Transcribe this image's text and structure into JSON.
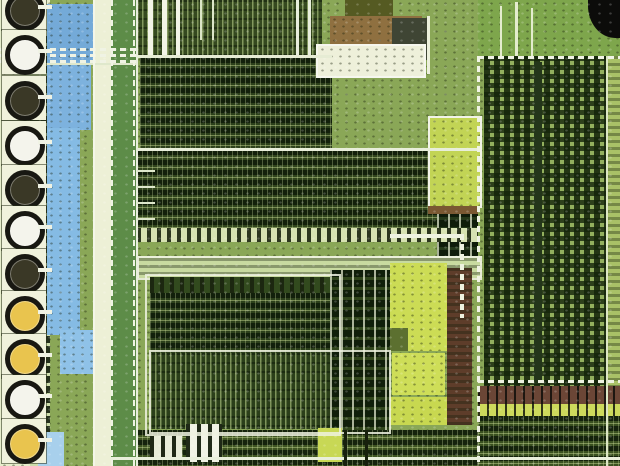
{
  "scene": {
    "type": "photomicrograph",
    "subject": "integrated-circuit die close-up",
    "description": "Optical microscope photograph of a silicon chip die: a column of round bond pads on the left, a light-blue metal bus strip, dense green standard-cell logic blocks in the center, bright yellow-green oxide regions, brown interconnect bands, and a large memory cell array on the right with a black blob in the top-right corner.",
    "visible_text": "none"
  },
  "photo": {
    "width": 620,
    "height": 466,
    "base_color": "#8aa757"
  },
  "palette": {
    "pale_field": "#e6edcb",
    "blue_metal": "#85bbe4",
    "cream": "#edf0d6",
    "bus_green": "#5d8c48",
    "dark_logic": "#2c401b",
    "mid_logic": "#31451d",
    "bright_yellow_green": "#ccdc55",
    "brown_band": "#8f7040",
    "maroon": "#5e3d2a",
    "memory_green": "#93b05e",
    "black": "#0c0c0a",
    "trace_white": "#f0f3e4",
    "pad_ring": "#181812"
  },
  "pad_column": {
    "background": "#e6edcb",
    "center_colors": {
      "dark": "#3a3826",
      "white": "#f4f4ec",
      "yellow": "#e9c44e"
    },
    "pads": [
      {
        "y": 8,
        "center": "dark"
      },
      {
        "y": 52,
        "center": "white"
      },
      {
        "y": 98,
        "center": "dark"
      },
      {
        "y": 143,
        "center": "white"
      },
      {
        "y": 187,
        "center": "dark"
      },
      {
        "y": 228,
        "center": "white"
      },
      {
        "y": 271,
        "center": "dark"
      },
      {
        "y": 313,
        "center": "yellow"
      },
      {
        "y": 356,
        "center": "yellow"
      },
      {
        "y": 397,
        "center": "white"
      },
      {
        "y": 441,
        "center": "yellow"
      }
    ]
  },
  "regions": [
    {
      "name": "base-field",
      "x": 0,
      "y": 0,
      "w": 620,
      "h": 466,
      "fill": "#8aa757",
      "tex": "speckle"
    },
    {
      "name": "pad-column",
      "x": 0,
      "y": 0,
      "w": 50,
      "h": 466,
      "fill": "#e6edcb",
      "tex": "speckle"
    },
    {
      "name": "pad-cell-strip",
      "x": 28,
      "y": 36,
      "w": 22,
      "h": 430,
      "fill": "#cdddab",
      "tex": "cells"
    },
    {
      "name": "blue-pool-top",
      "x": 47,
      "y": 4,
      "w": 48,
      "h": 58,
      "fill": "#74aad8",
      "tex": "speckle"
    },
    {
      "name": "blue-pool-mid",
      "x": 47,
      "y": 62,
      "w": 44,
      "h": 68,
      "fill": "#7db2de",
      "tex": "speckle"
    },
    {
      "name": "blue-bus-strip",
      "x": 47,
      "y": 128,
      "w": 33,
      "h": 207,
      "fill": "#85bbe4",
      "tex": "speckle"
    },
    {
      "name": "blue-pool-low",
      "x": 60,
      "y": 330,
      "w": 40,
      "h": 44,
      "fill": "#8fc2e8",
      "tex": "speckle"
    },
    {
      "name": "blue-pool-bottom",
      "x": 38,
      "y": 432,
      "w": 26,
      "h": 34,
      "fill": "#a8d0ec",
      "tex": null
    },
    {
      "name": "cream-strip",
      "x": 94,
      "y": 0,
      "w": 18,
      "h": 466,
      "fill": "#edf0d6",
      "tex": null
    },
    {
      "name": "green-power-bus",
      "x": 111,
      "y": 0,
      "w": 26,
      "h": 466,
      "fill": "#5d8c48",
      "tex": null
    },
    {
      "name": "top-logic-banner",
      "x": 137,
      "y": 0,
      "w": 185,
      "h": 58,
      "fill": "#35491f",
      "tex": "vstripes"
    },
    {
      "name": "top-dense-block",
      "x": 140,
      "y": 58,
      "w": 192,
      "h": 92,
      "fill": "#2c401b",
      "tex": "logic-rows"
    },
    {
      "name": "olive-patch",
      "x": 345,
      "y": 0,
      "w": 48,
      "h": 18,
      "fill": "#555a22",
      "tex": null
    },
    {
      "name": "brown-band-top",
      "x": 330,
      "y": 16,
      "w": 92,
      "h": 28,
      "fill": "#8f7040",
      "tex": "speckle"
    },
    {
      "name": "gray-block",
      "x": 392,
      "y": 18,
      "w": 38,
      "h": 42,
      "fill": "#3f4534",
      "tex": null
    },
    {
      "name": "cream-block",
      "x": 316,
      "y": 44,
      "w": 106,
      "h": 30,
      "fill": "#eef0da",
      "tex": "speckle",
      "border": "2px solid #f6f7ee"
    },
    {
      "name": "mid-logic-block",
      "x": 137,
      "y": 150,
      "w": 300,
      "h": 82,
      "fill": "#31451d",
      "tex": "logic-rows"
    },
    {
      "name": "cell-column-right",
      "x": 437,
      "y": 150,
      "w": 41,
      "h": 106,
      "fill": "#24381a",
      "tex": "cells"
    },
    {
      "name": "bright-cell-row",
      "x": 137,
      "y": 228,
      "w": 341,
      "h": 14,
      "fill": "#d7e2b2",
      "tex": "comb"
    },
    {
      "name": "light-bus-strip",
      "x": 137,
      "y": 256,
      "w": 341,
      "h": 20,
      "fill": "#c8daa0",
      "tex": "hrows-soft",
      "border": "2px solid rgba(238,242,224,0.9)"
    },
    {
      "name": "comb-row-lower-left",
      "x": 150,
      "y": 277,
      "w": 180,
      "h": 16,
      "fill": "#324a1e",
      "tex": "comb"
    },
    {
      "name": "lower-left-dense",
      "x": 150,
      "y": 293,
      "w": 180,
      "h": 60,
      "fill": "#2c401b",
      "tex": "logic-rows"
    },
    {
      "name": "stripe-panel",
      "x": 150,
      "y": 353,
      "w": 235,
      "h": 76,
      "fill": "#2b3f1a",
      "tex": "vstripes"
    },
    {
      "name": "cell-pair-column",
      "x": 330,
      "y": 270,
      "w": 60,
      "h": 160,
      "fill": "#30451c",
      "tex": "cells"
    },
    {
      "name": "yellow-field-a",
      "x": 390,
      "y": 263,
      "w": 57,
      "h": 88,
      "fill": "#ccdc55",
      "tex": "speckle"
    },
    {
      "name": "yellow-notch",
      "x": 390,
      "y": 328,
      "w": 18,
      "h": 23,
      "fill": "#5c7030",
      "tex": null
    },
    {
      "name": "yellow-field-b",
      "x": 392,
      "y": 353,
      "w": 53,
      "h": 42,
      "fill": "#cede58",
      "tex": "speckle"
    },
    {
      "name": "yellow-field-c",
      "x": 390,
      "y": 397,
      "w": 57,
      "h": 28,
      "fill": "#c8d850",
      "tex": "speckle"
    },
    {
      "name": "maroon-strip",
      "x": 447,
      "y": 268,
      "w": 25,
      "h": 157,
      "fill": "#5e3d2a",
      "tex": "hrows-soft"
    },
    {
      "name": "framed-yellow-block",
      "x": 428,
      "y": 116,
      "w": 50,
      "h": 88,
      "fill": "#c2d455",
      "tex": "speckle",
      "border": "2px solid #f2f4e8"
    },
    {
      "name": "brown-sliver",
      "x": 428,
      "y": 206,
      "w": 50,
      "h": 8,
      "fill": "#7a5832",
      "tex": null
    },
    {
      "name": "memory-apron",
      "x": 478,
      "y": 0,
      "w": 142,
      "h": 56,
      "fill": "#7ea64c",
      "tex": "speckle"
    },
    {
      "name": "memory-array",
      "x": 484,
      "y": 56,
      "w": 124,
      "h": 330,
      "fill": "#93b05e",
      "tex": "grid"
    },
    {
      "name": "memory-divider",
      "x": 534,
      "y": 62,
      "w": 8,
      "h": 322,
      "fill": "#24361a",
      "tex": null
    },
    {
      "name": "memory-edge-column",
      "x": 608,
      "y": 56,
      "w": 12,
      "h": 410,
      "fill": "#a9c167",
      "tex": "hrows-soft"
    },
    {
      "name": "corner-blob",
      "x": 588,
      "y": 0,
      "w": 32,
      "h": 38,
      "fill": "#0c0c0a",
      "tex": null,
      "radius": "0 0 0 85%"
    },
    {
      "name": "brown-band-right",
      "x": 478,
      "y": 386,
      "w": 142,
      "h": 18,
      "fill": "#6b4636",
      "tex": "ticks-v"
    },
    {
      "name": "yellow-strip-right",
      "x": 478,
      "y": 404,
      "w": 142,
      "h": 12,
      "fill": "#cdd95c",
      "tex": "ticks-v"
    },
    {
      "name": "bottom-right-dense",
      "x": 478,
      "y": 416,
      "w": 142,
      "h": 50,
      "fill": "#3a5020",
      "tex": "logic-rows"
    },
    {
      "name": "bottom-mid-dense",
      "x": 137,
      "y": 430,
      "w": 341,
      "h": 36,
      "fill": "#3f5522",
      "tex": "logic-rows"
    },
    {
      "name": "yellow-patch-bottom",
      "x": 318,
      "y": 428,
      "w": 24,
      "h": 34,
      "fill": "#c8d855",
      "tex": null
    },
    {
      "name": "ladder-structure-large",
      "x": 186,
      "y": 424,
      "w": 36,
      "h": 38,
      "fill": "#f0f2e4",
      "tex": "comb-big"
    },
    {
      "name": "ladder-structure-small",
      "x": 150,
      "y": 436,
      "w": 32,
      "h": 24,
      "fill": "#e8ecd8",
      "tex": "comb-big"
    },
    {
      "name": "frame-lower-left",
      "x": 145,
      "y": 274,
      "w": 192,
      "h": 158,
      "fill": "none",
      "tex": null,
      "border": "2px solid rgba(238,242,224,0.85)"
    },
    {
      "name": "frame-stripe-panel",
      "x": 149,
      "y": 350,
      "w": 238,
      "h": 80,
      "fill": "none",
      "tex": null,
      "border": "2px solid rgba(238,242,224,0.85)"
    },
    {
      "name": "photo-grain",
      "x": 0,
      "y": 0,
      "w": 620,
      "h": 466,
      "fill": "none",
      "tex": "speckle-lt"
    }
  ],
  "lines": [
    {
      "name": "pad-bus-trace-1",
      "x": 0,
      "y": 48,
      "w": 137,
      "h": 3,
      "color": "#f0f3e4",
      "dash": "h"
    },
    {
      "name": "pad-bus-trace-2",
      "x": 0,
      "y": 54,
      "w": 137,
      "h": 3,
      "color": "#f0f3e4",
      "dash": "h"
    },
    {
      "name": "pad-bus-trace-3",
      "x": 0,
      "y": 60,
      "w": 137,
      "h": 3,
      "color": "#f0f3e4",
      "dash": "h"
    },
    {
      "name": "blue-divider",
      "x": 47,
      "y": 63,
      "w": 90,
      "h": 2,
      "color": "#dfe8cc",
      "dash": null
    },
    {
      "name": "cream-left-edge",
      "x": 93,
      "y": 0,
      "w": 2,
      "h": 466,
      "color": "#f4f6e8",
      "dash": null
    },
    {
      "name": "bus-dash-left",
      "x": 111,
      "y": 0,
      "w": 2,
      "h": 466,
      "color": "#f0f3e4",
      "dash": "v"
    },
    {
      "name": "bus-dash-right",
      "x": 133,
      "y": 0,
      "w": 2,
      "h": 466,
      "color": "#f0f3e4",
      "dash": "v"
    },
    {
      "name": "main-left-edge",
      "x": 136,
      "y": 0,
      "w": 2,
      "h": 466,
      "color": "#e8eedc",
      "dash": null
    },
    {
      "name": "bondwire-bar-1",
      "x": 148,
      "y": 0,
      "w": 5,
      "h": 58,
      "color": "#f2f4e6",
      "dash": null
    },
    {
      "name": "bondwire-bar-2",
      "x": 162,
      "y": 0,
      "w": 5,
      "h": 58,
      "color": "#f2f4e6",
      "dash": null
    },
    {
      "name": "bondwire-bar-3",
      "x": 176,
      "y": 0,
      "w": 4,
      "h": 58,
      "color": "#f2f4e6",
      "dash": null
    },
    {
      "name": "top-thin-line-1",
      "x": 200,
      "y": 0,
      "w": 2,
      "h": 40,
      "color": "#dce6c8",
      "dash": null
    },
    {
      "name": "top-thin-line-2",
      "x": 212,
      "y": 0,
      "w": 2,
      "h": 40,
      "color": "#dce6c8",
      "dash": null
    },
    {
      "name": "top-thin-line-3",
      "x": 296,
      "y": 0,
      "w": 3,
      "h": 58,
      "color": "#e8eedc",
      "dash": null
    },
    {
      "name": "top-thin-line-4",
      "x": 308,
      "y": 0,
      "w": 3,
      "h": 58,
      "color": "#e8eedc",
      "dash": null
    },
    {
      "name": "h-bus-55",
      "x": 137,
      "y": 55,
      "w": 195,
      "h": 3,
      "color": "#e6ecd4",
      "dash": null
    },
    {
      "name": "h-bus-148",
      "x": 137,
      "y": 148,
      "w": 341,
      "h": 3,
      "color": "#e8eeda",
      "dash": null
    },
    {
      "name": "bus-stub-1",
      "x": 137,
      "y": 170,
      "w": 18,
      "h": 2,
      "color": "#dfe8cc",
      "dash": null
    },
    {
      "name": "bus-stub-2",
      "x": 137,
      "y": 186,
      "w": 18,
      "h": 2,
      "color": "#dfe8cc",
      "dash": null
    },
    {
      "name": "bus-stub-3",
      "x": 137,
      "y": 202,
      "w": 18,
      "h": 2,
      "color": "#dfe8cc",
      "dash": null
    },
    {
      "name": "bus-stub-4",
      "x": 137,
      "y": 218,
      "w": 18,
      "h": 2,
      "color": "#dfe8cc",
      "dash": null
    },
    {
      "name": "trace-h-236",
      "x": 390,
      "y": 234,
      "w": 74,
      "h": 4,
      "color": "#eef2e0",
      "dash": null
    },
    {
      "name": "trace-v-460",
      "x": 460,
      "y": 234,
      "w": 4,
      "h": 84,
      "color": "#eef2e0",
      "dash": "v"
    },
    {
      "name": "vertical-trace-428",
      "x": 427,
      "y": 16,
      "w": 3,
      "h": 58,
      "color": "#ecf0dc",
      "dash": null
    },
    {
      "name": "memory-border-h",
      "x": 478,
      "y": 56,
      "w": 142,
      "h": 3,
      "color": "#f0f3e4",
      "dash": "h"
    },
    {
      "name": "memory-border-v",
      "x": 477,
      "y": 56,
      "w": 3,
      "h": 410,
      "color": "#f0f3e4",
      "dash": "v"
    },
    {
      "name": "memory-top-bar-1",
      "x": 500,
      "y": 6,
      "w": 2,
      "h": 50,
      "color": "#e4ecce",
      "dash": null
    },
    {
      "name": "memory-top-bar-2",
      "x": 515,
      "y": 2,
      "w": 3,
      "h": 54,
      "color": "#e4ecce",
      "dash": null
    },
    {
      "name": "memory-top-bar-3",
      "x": 531,
      "y": 8,
      "w": 2,
      "h": 48,
      "color": "#e4ecce",
      "dash": null
    },
    {
      "name": "memory-white-380",
      "x": 478,
      "y": 380,
      "w": 142,
      "h": 3,
      "color": "#eef2e0",
      "dash": "h"
    },
    {
      "name": "memory-right-edge",
      "x": 606,
      "y": 56,
      "w": 2,
      "h": 410,
      "color": "#dce6c4",
      "dash": null
    },
    {
      "name": "bottom-white-line",
      "x": 110,
      "y": 457,
      "w": 510,
      "h": 3,
      "color": "#e9efdb",
      "dash": null
    },
    {
      "name": "black-post-1",
      "x": 344,
      "y": 430,
      "w": 3,
      "h": 36,
      "color": "#17200d",
      "dash": null
    },
    {
      "name": "black-post-2",
      "x": 365,
      "y": 430,
      "w": 3,
      "h": 36,
      "color": "#17200d",
      "dash": null
    }
  ]
}
